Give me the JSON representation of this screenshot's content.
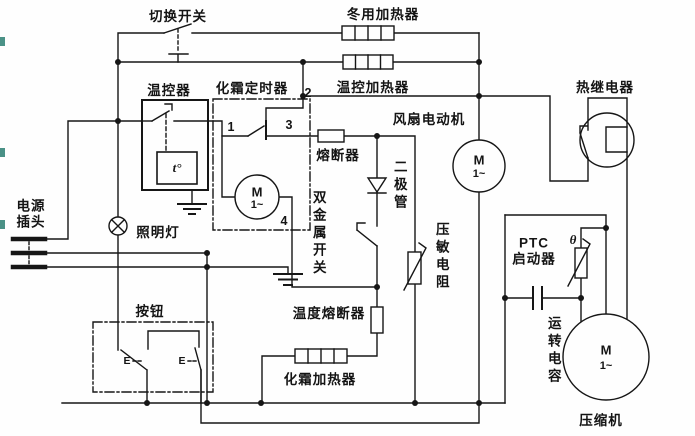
{
  "diagram_type": "refrigerator-wiring-schematic",
  "colors": {
    "line": "#161616",
    "background": "#fefefe",
    "edge_marks": "#2b7f72"
  },
  "labels": {
    "changeover_switch": "切换开关",
    "winter_heater": "冬用加热器",
    "thermo_heater": "温控加热器",
    "thermostat": "温控器",
    "defrost_timer": "化霜定时器",
    "fuse": "熔断器",
    "fan_motor": "风扇电动机",
    "thermal_relay": "热继电器",
    "diode": "二极管",
    "bimetal_switch": "双金属开关",
    "varistor": "压敏电阻",
    "power_plug_line1": "电源",
    "power_plug_line2": "插头",
    "lamp": "照明灯",
    "button": "按钮",
    "thermal_fuse": "温度熔断器",
    "defrost_heater": "化霜加热器",
    "ptc_line1": "PTC",
    "ptc_line2": "启动器",
    "run_capacitor": "运转电容",
    "compressor": "压缩机"
  },
  "symbols": {
    "thermostat_temp": "t°",
    "thermistor_theta": "θ",
    "motor_m": "M",
    "motor_phase": "1~",
    "button_contact": "E"
  },
  "terminals": {
    "t1": "1",
    "t2": "2",
    "t3": "3",
    "t4": "4"
  }
}
